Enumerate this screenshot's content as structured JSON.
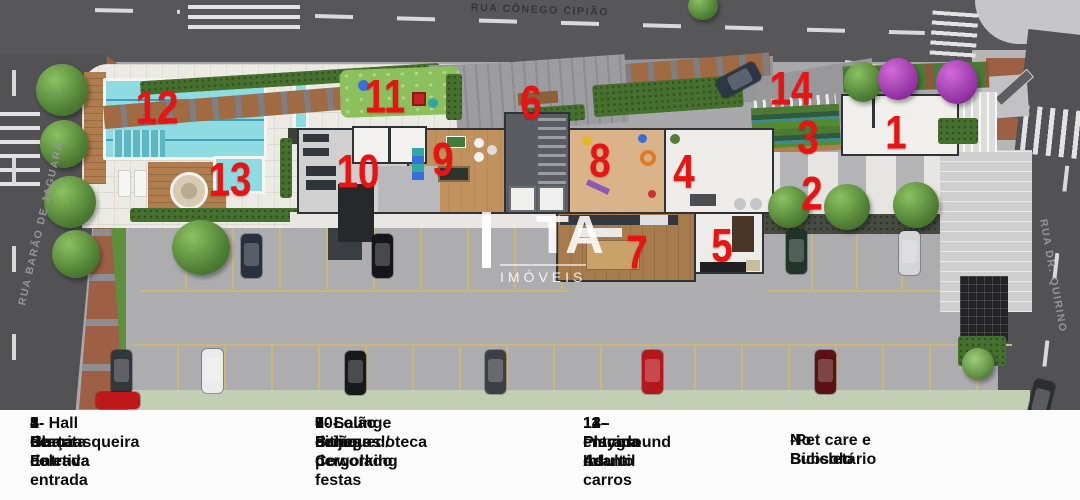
{
  "streets": {
    "top": "RUA CÔNEGO CIPIÃO",
    "left": "RUA BARÃO DE JAGUARA",
    "right": "RUA DR. QUIRINO"
  },
  "watermark": {
    "brand": "TA",
    "subtitle": "IMÓVEIS"
  },
  "markers": {
    "n1": "1",
    "n2": "2",
    "n3": "3",
    "n4": "4",
    "n5": "5",
    "n6": "6",
    "n7": "7",
    "n8": "8",
    "n9": "9",
    "n10": "10",
    "n11": "11",
    "n12": "12",
    "n13": "13",
    "n14": "14"
  },
  "legend": {
    "col1": [
      "1- Guarita",
      "2- Praça de entrada",
      "3- Horta coletiva",
      "4- Hall de Entrada",
      "5- Churrasqueira"
    ],
    "col2": [
      "6- Lounge com pergolado",
      "7- Salão de festas",
      "8- Brinquedoteca",
      "9- Salão de jogos / Coworking",
      "10- Fitness"
    ],
    "col3": [
      "11 -Playground",
      "12- Piscina Adulto",
      "13- Piscina Infantil",
      "14- entrada de carros"
    ],
    "col4": [
      "No Subsolo",
      "-Pet care e  Bicicletário"
    ]
  },
  "colors": {
    "marker_red": "#e81313",
    "asphalt": "#57575a",
    "pool_water": "#8edbe2",
    "parking": "#adadb0",
    "lawn": "#c3cfb4",
    "brick_sidewalk": "#9d6045"
  }
}
